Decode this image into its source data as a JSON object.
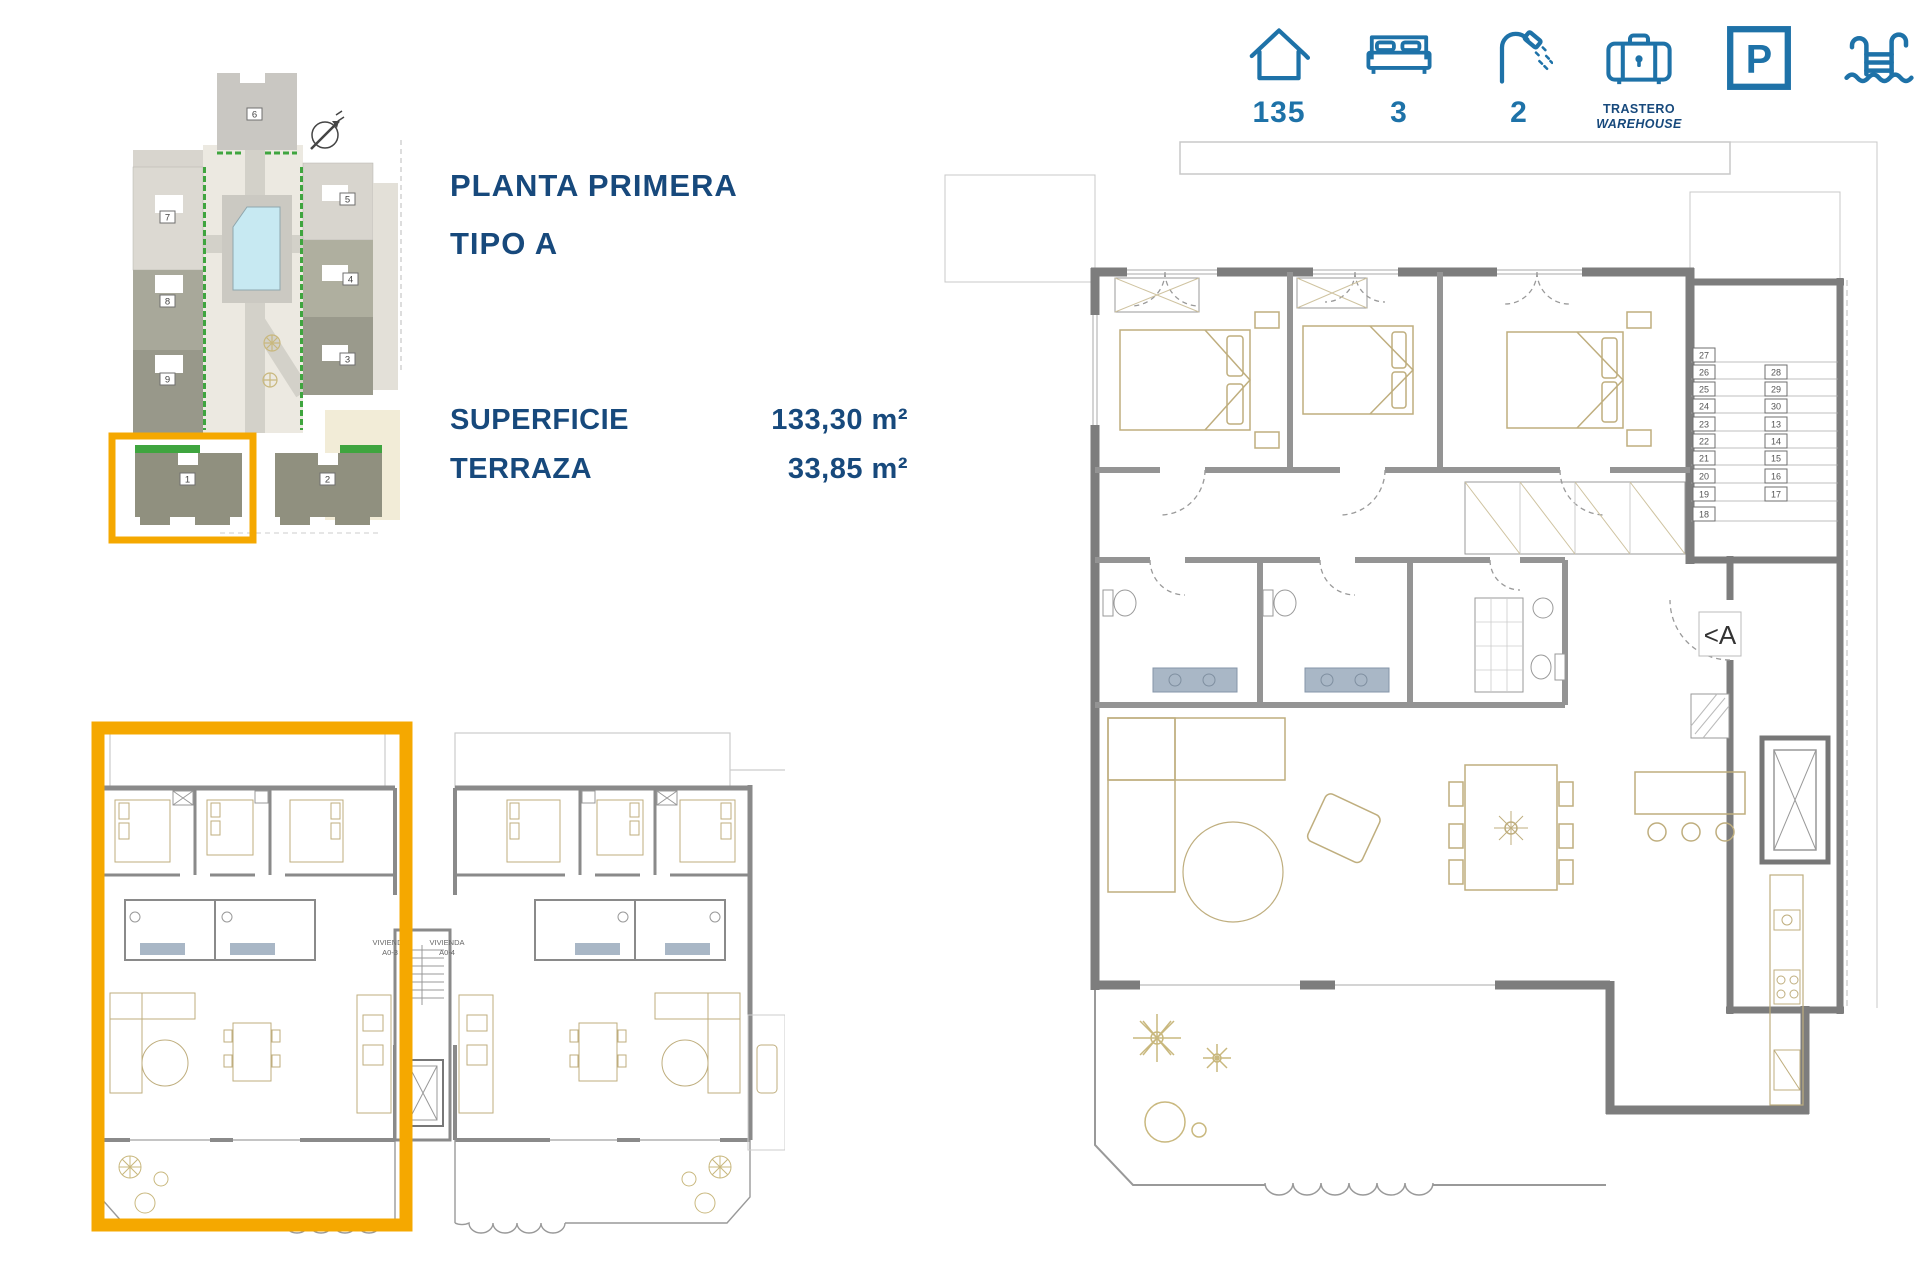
{
  "title": {
    "line1": "PLANTA PRIMERA",
    "line2": "TIPO A"
  },
  "specs": {
    "rows": [
      {
        "label": "SUPERFICIE",
        "value": "133,30 m²"
      },
      {
        "label": "TERRAZA",
        "value": "33,85 m²"
      }
    ]
  },
  "summary_icons": {
    "area": {
      "icon": "house-icon",
      "value": "135"
    },
    "bedrooms": {
      "icon": "bed-icon",
      "value": "3"
    },
    "bathrooms": {
      "icon": "shower-icon",
      "value": "2"
    },
    "storage": {
      "icon": "warehouse-icon",
      "label_es": "TRASTERO",
      "label_en": "WAREHOUSE"
    },
    "parking": {
      "icon": "parking-icon",
      "glyph": "P"
    },
    "pool": {
      "icon": "pool-icon"
    }
  },
  "site_plan": {
    "building_numbers": [
      "1",
      "2",
      "3",
      "4",
      "5",
      "6",
      "7",
      "8",
      "9"
    ]
  },
  "overview_plan": {
    "units": [
      {
        "name": "VIVIENDA",
        "code": "A0-3"
      },
      {
        "name": "VIVIENDA",
        "code": "A0-4"
      }
    ]
  },
  "detail_plan": {
    "entrance_label": "<A",
    "storage_numbers_left": [
      "27",
      "26",
      "25",
      "24",
      "23",
      "22",
      "21",
      "20",
      "19",
      "18"
    ],
    "storage_numbers_right": [
      "28",
      "29",
      "30",
      "13",
      "14",
      "15",
      "16",
      "17"
    ]
  },
  "colors": {
    "navy": "#17497C",
    "accent_blue": "#1E72A8",
    "highlight_orange": "#F5A800",
    "wall_gray": "#7D7D7D",
    "furniture_tan": "#BFAE7E",
    "pool_blue": "#C7E9F2"
  }
}
